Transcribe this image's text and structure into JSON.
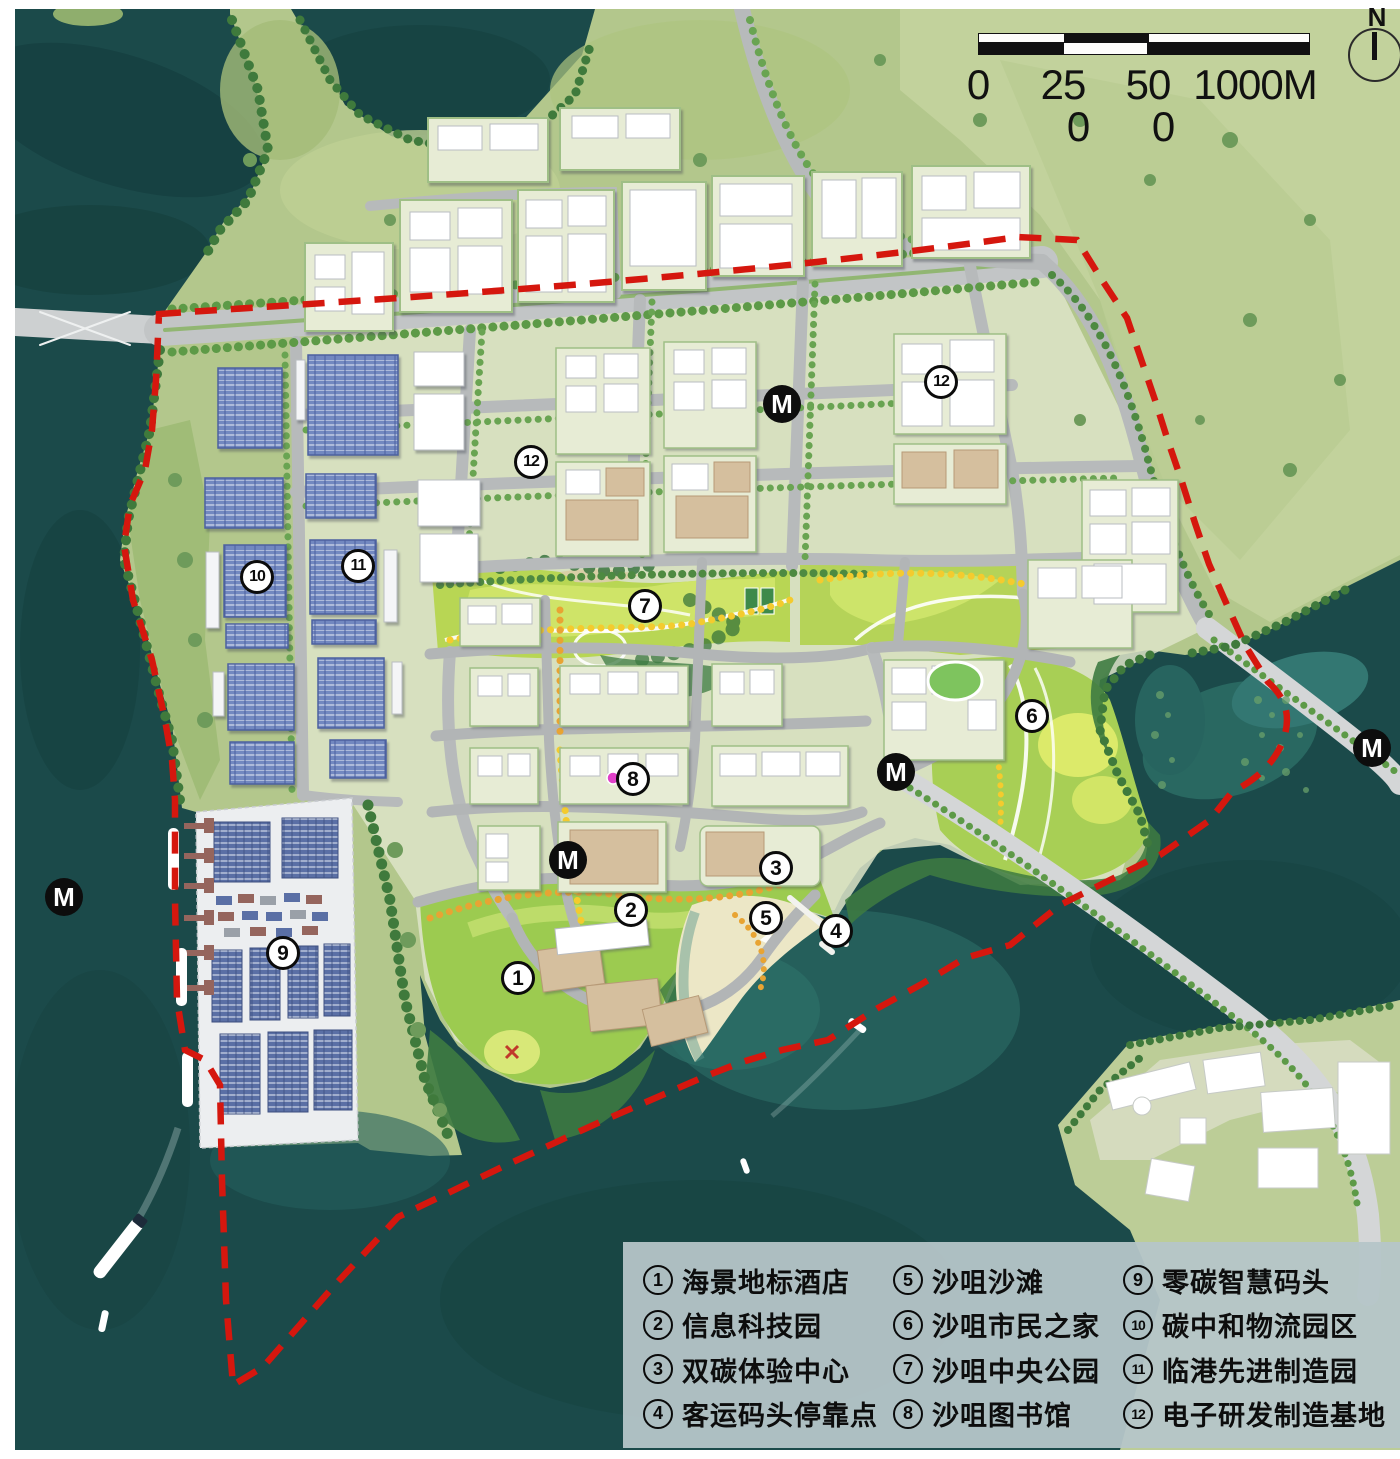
{
  "map": {
    "type": "urban-masterplan-rendering",
    "boundary_style": "red-dashed",
    "colors": {
      "water": "#1b4a4a",
      "water_shallow": "#2a6a64",
      "land": "#b3c78c",
      "meadow": "#c2d29c",
      "urban_block": "#e4e9d0",
      "road": "#bcbfc0",
      "bridge": "#d4d6d7",
      "boundary_red": "#d5170e",
      "solar_blue": "#7288c0",
      "sand": "#ece7c6",
      "park_green": "#c4e060",
      "tree_green": "#4e8a41",
      "building_white": "#ffffff",
      "beige_building": "#d5bf9e",
      "legend_bg": "#b5c5c8",
      "marker_bg": "#ffffff",
      "metro_bg": "#0d0d0d"
    }
  },
  "north_arrow": {
    "label": "N"
  },
  "scale_bar": {
    "ticks": [
      {
        "label": "0",
        "x": 0,
        "row": 1
      },
      {
        "label": "25",
        "x": 85,
        "row": 1
      },
      {
        "label": "50",
        "x": 170,
        "row": 1
      },
      {
        "label": "1000M",
        "x": 277,
        "row": 1
      },
      {
        "label": "0",
        "x": 100,
        "row": 2
      },
      {
        "label": "0",
        "x": 185,
        "row": 2
      }
    ]
  },
  "metro": {
    "symbol": "M",
    "stations": [
      {
        "x": 64,
        "y": 897
      },
      {
        "x": 568,
        "y": 860
      },
      {
        "x": 782,
        "y": 404
      },
      {
        "x": 896,
        "y": 772
      },
      {
        "x": 1372,
        "y": 748
      }
    ]
  },
  "map_markers": [
    {
      "num": "1",
      "x": 518,
      "y": 978
    },
    {
      "num": "2",
      "x": 631,
      "y": 910
    },
    {
      "num": "3",
      "x": 776,
      "y": 868
    },
    {
      "num": "4",
      "x": 836,
      "y": 931
    },
    {
      "num": "5",
      "x": 766,
      "y": 918
    },
    {
      "num": "6",
      "x": 1032,
      "y": 716
    },
    {
      "num": "7",
      "x": 645,
      "y": 606
    },
    {
      "num": "8",
      "x": 633,
      "y": 779
    },
    {
      "num": "9",
      "x": 283,
      "y": 953
    },
    {
      "num": "10",
      "x": 257,
      "y": 577
    },
    {
      "num": "11",
      "x": 358,
      "y": 566
    },
    {
      "num": "12",
      "x": 531,
      "y": 462
    },
    {
      "num": "12",
      "x": 941,
      "y": 382
    }
  ],
  "legend": {
    "items": [
      {
        "num": "1",
        "label": "海景地标酒店"
      },
      {
        "num": "2",
        "label": "信息科技园"
      },
      {
        "num": "3",
        "label": "双碳体验中心"
      },
      {
        "num": "4",
        "label": "客运码头停靠点"
      },
      {
        "num": "5",
        "label": "沙咀沙滩"
      },
      {
        "num": "6",
        "label": "沙咀市民之家"
      },
      {
        "num": "7",
        "label": "沙咀中央公园"
      },
      {
        "num": "8",
        "label": "沙咀图书馆"
      },
      {
        "num": "9",
        "label": "零碳智慧码头"
      },
      {
        "num": "10",
        "label": "碳中和物流园区"
      },
      {
        "num": "11",
        "label": "临港先进制造园"
      },
      {
        "num": "12",
        "label": "电子研发制造基地"
      }
    ]
  }
}
